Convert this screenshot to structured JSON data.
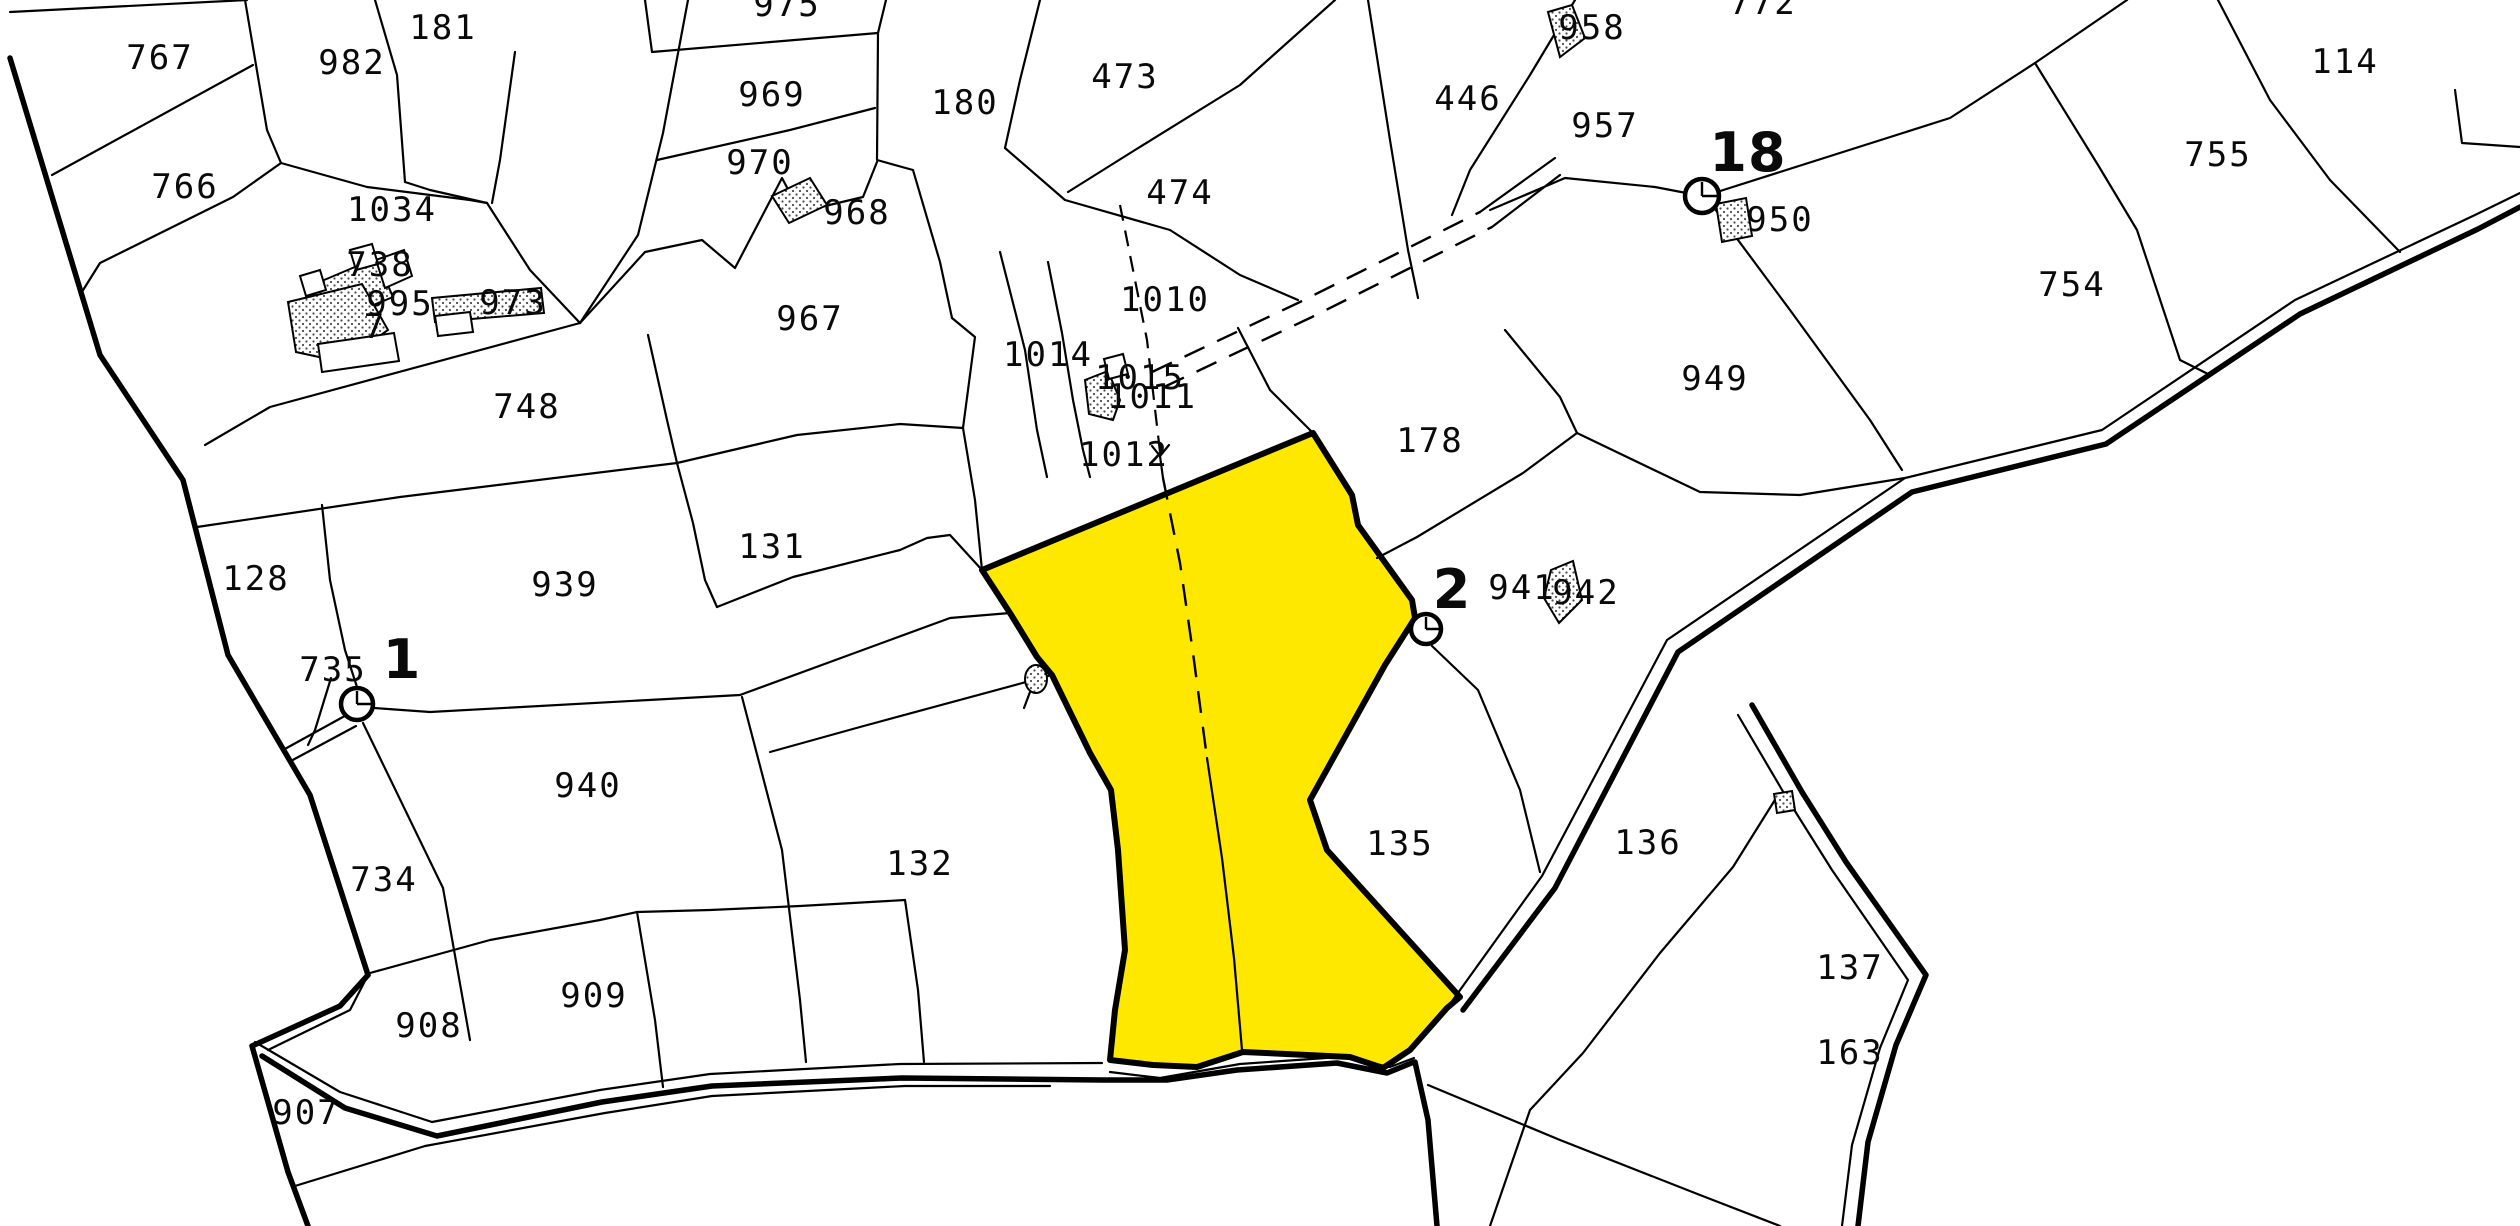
{
  "map": {
    "type": "cadastral-parcel-map",
    "highlight_color": "#ffe800",
    "line_color": "#000000",
    "background_color": "#ffffff",
    "selected_parcel": "yellow-highlighted-parcel",
    "survey_points": [
      {
        "id": "1",
        "x": 402,
        "y": 678
      },
      {
        "id": "2",
        "x": 1452,
        "y": 608
      },
      {
        "id": "18",
        "x": 1748,
        "y": 171
      }
    ],
    "parcel_labels": [
      {
        "text": "767",
        "x": 160,
        "y": 69
      },
      {
        "text": "982",
        "x": 352,
        "y": 74
      },
      {
        "text": "181",
        "x": 443,
        "y": 39
      },
      {
        "text": "766",
        "x": 185,
        "y": 198
      },
      {
        "text": "1034",
        "x": 392,
        "y": 221
      },
      {
        "text": "975",
        "x": 787,
        "y": 16
      },
      {
        "text": "969",
        "x": 772,
        "y": 106
      },
      {
        "text": "970",
        "x": 760,
        "y": 174
      },
      {
        "text": "968",
        "x": 857,
        "y": 224
      },
      {
        "text": "967",
        "x": 810,
        "y": 330
      },
      {
        "text": "748",
        "x": 527,
        "y": 418
      },
      {
        "text": "180",
        "x": 965,
        "y": 114
      },
      {
        "text": "473",
        "x": 1125,
        "y": 88
      },
      {
        "text": "474",
        "x": 1180,
        "y": 204
      },
      {
        "text": "1010",
        "x": 1165,
        "y": 311
      },
      {
        "text": "1014",
        "x": 1048,
        "y": 366
      },
      {
        "text": "1015",
        "x": 1140,
        "y": 389
      },
      {
        "text": "1011",
        "x": 1152,
        "y": 408
      },
      {
        "text": "1012",
        "x": 1124,
        "y": 466
      },
      {
        "text": "178",
        "x": 1430,
        "y": 452
      },
      {
        "text": "446",
        "x": 1468,
        "y": 110
      },
      {
        "text": "957",
        "x": 1605,
        "y": 137
      },
      {
        "text": "958",
        "x": 1592,
        "y": 39
      },
      {
        "text": "772",
        "x": 1763,
        "y": 14
      },
      {
        "text": "950",
        "x": 1780,
        "y": 231
      },
      {
        "text": "949",
        "x": 1715,
        "y": 390
      },
      {
        "text": "941",
        "x": 1522,
        "y": 599
      },
      {
        "text": "942",
        "x": 1586,
        "y": 604
      },
      {
        "text": "755",
        "x": 2218,
        "y": 166
      },
      {
        "text": "754",
        "x": 2072,
        "y": 296
      },
      {
        "text": "114",
        "x": 2345,
        "y": 73
      },
      {
        "text": "128",
        "x": 256,
        "y": 590
      },
      {
        "text": "939",
        "x": 565,
        "y": 596
      },
      {
        "text": "131",
        "x": 772,
        "y": 558
      },
      {
        "text": "735",
        "x": 333,
        "y": 681
      },
      {
        "text": "940",
        "x": 588,
        "y": 797
      },
      {
        "text": "734",
        "x": 384,
        "y": 891
      },
      {
        "text": "908",
        "x": 429,
        "y": 1037
      },
      {
        "text": "909",
        "x": 594,
        "y": 1007
      },
      {
        "text": "907",
        "x": 306,
        "y": 1124
      },
      {
        "text": "132",
        "x": 920,
        "y": 875
      },
      {
        "text": "135",
        "x": 1400,
        "y": 855
      },
      {
        "text": "136",
        "x": 1648,
        "y": 854
      },
      {
        "text": "137",
        "x": 1850,
        "y": 979
      },
      {
        "text": "163",
        "x": 1850,
        "y": 1064
      },
      {
        "text": "738",
        "x": 380,
        "y": 276
      },
      {
        "text": "995",
        "x": 400,
        "y": 315
      },
      {
        "text": "973",
        "x": 513,
        "y": 314
      },
      {
        "text": "7",
        "x": 375,
        "y": 338
      }
    ]
  }
}
